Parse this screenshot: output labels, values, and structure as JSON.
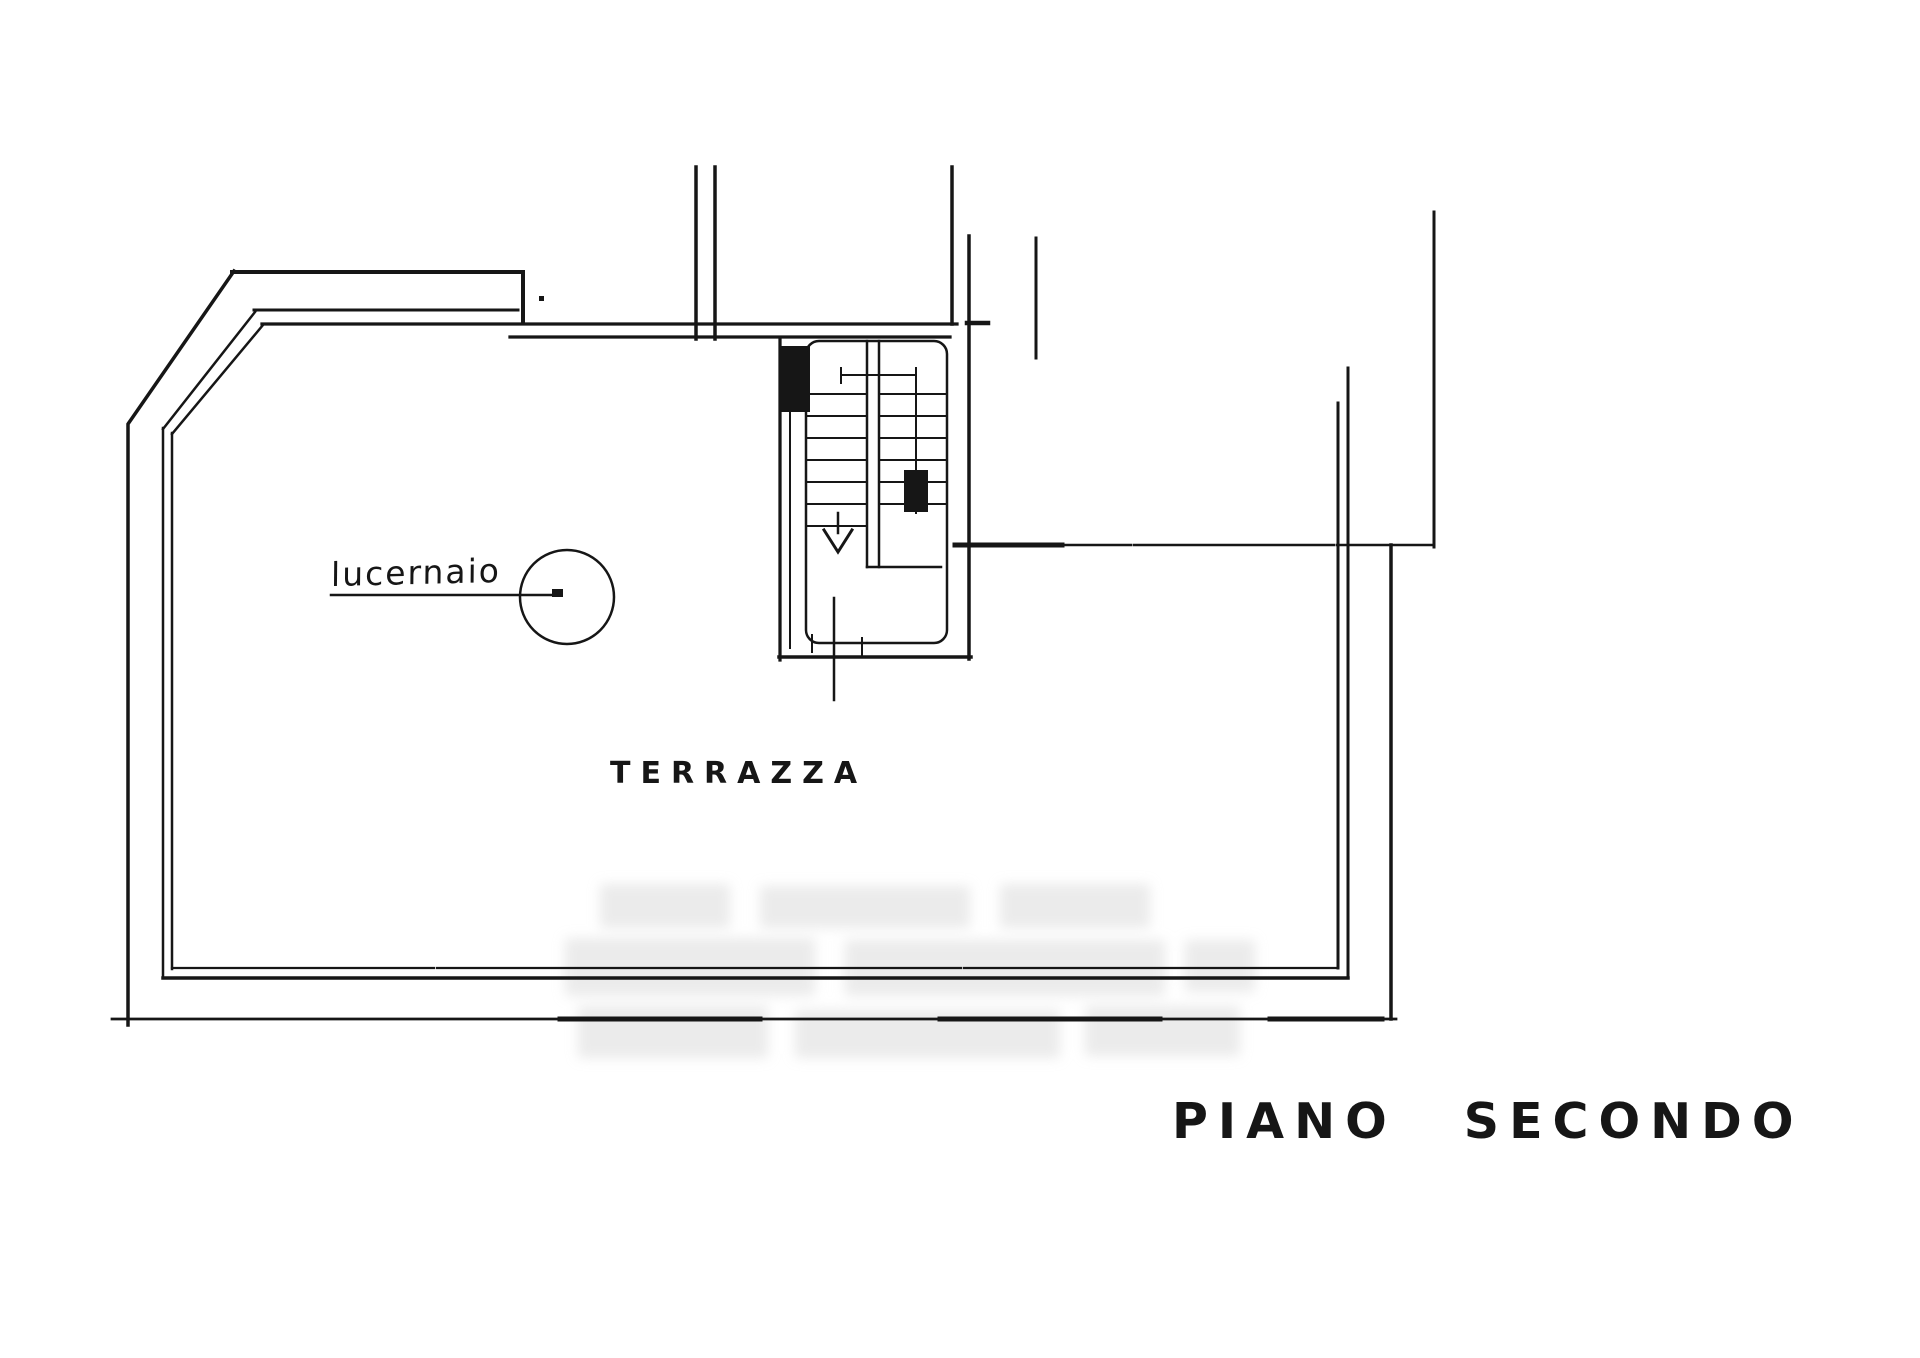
{
  "page": {
    "background_color": "#ffffff",
    "ink_color": "#161616",
    "watermark_color": "#dedede",
    "kind": "scanned floor plan drawing"
  },
  "plan": {
    "floor_title": "PIANO SECONDO",
    "labels": {
      "terrace": "TERRAZZA",
      "skylight": "lucernaio"
    }
  }
}
